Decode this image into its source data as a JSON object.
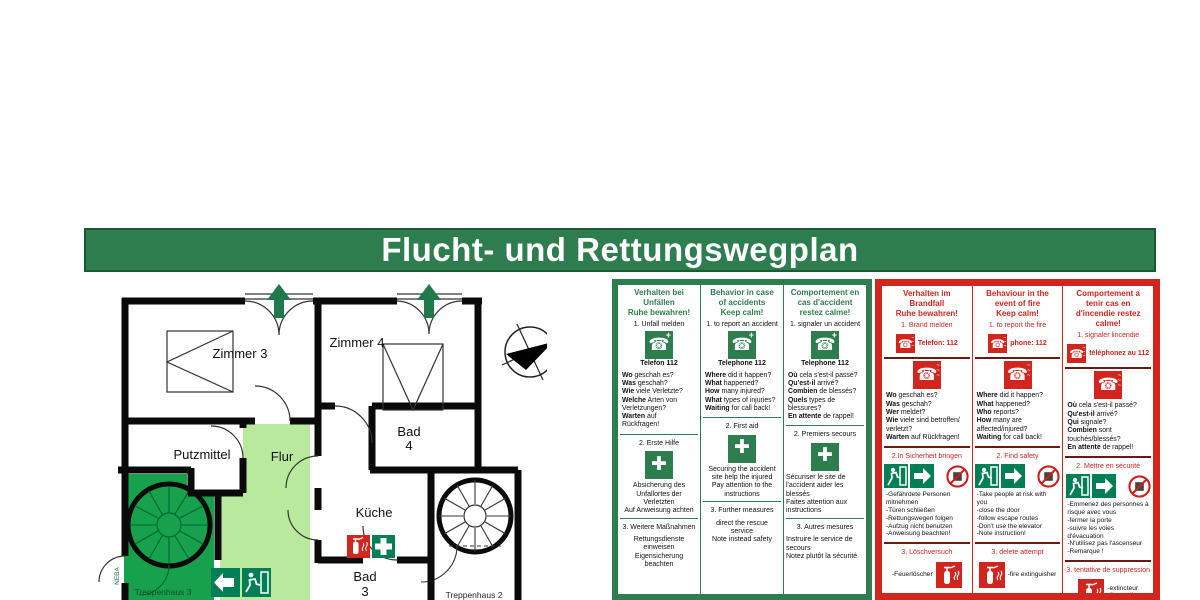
{
  "title": "Flucht- und Rettungswegplan",
  "colors": {
    "safety_green": "#2e7d4e",
    "safety_red": "#d1251d",
    "corridor_light_green": "#b9e99d",
    "stair_green": "#18a14d",
    "sign_green": "#007f56"
  },
  "floorplan": {
    "rooms": {
      "zimmer3": "Zimmer 3",
      "zimmer4": "Zimmer 4",
      "bad4_l1": "Bad",
      "bad4_l2": "4",
      "putzmittel": "Putzmittel",
      "flur": "Flur",
      "kueche": "Küche",
      "bad3_l1": "Bad",
      "bad3_l2": "3",
      "treppenhaus3": "Treppenhaus 3",
      "treppenhaus2": "Treppenhaus 2"
    },
    "compass_label": "Z",
    "side_label": "NEBA"
  },
  "accident_panel": {
    "columns": [
      {
        "header": "Verhalten bei\nUnfällen\nRuhe bewahren!",
        "step1": "1. Unfall melden",
        "phone_label": "Telefon  112",
        "questions": [
          {
            "b": "Wo",
            "t": " geschah es?"
          },
          {
            "b": "Was",
            "t": " geschah?"
          },
          {
            "b": "Wie",
            "t": " viele Verletzte?"
          },
          {
            "b": "Welche",
            "t": " Arten von"
          },
          {
            "b": "",
            "t": "Verletzungen?"
          },
          {
            "b": "Warten",
            "t": " auf"
          },
          {
            "b": "",
            "t": "Rückfragen!"
          }
        ],
        "step2": "2. Erste Hilfe",
        "step2_text": "Absicherung des\nUnfallortes der\nVerletzten\nAuf Anweisung achten",
        "step3": "3. Weitere Maßnahmen",
        "step3_text": "Rettungsdienste\neinweisen\nEigensicherung\nbeachten"
      },
      {
        "header": "Behavior in case\nof accidents\nKeep calm!",
        "step1": "1. to report an accident",
        "phone_label": "Telephone  112",
        "questions": [
          {
            "b": "Where",
            "t": " did it happen?"
          },
          {
            "b": "What",
            "t": " happened?"
          },
          {
            "b": "How",
            "t": " many injured?"
          },
          {
            "b": "What",
            "t": " types of injuries?"
          },
          {
            "b": "Waiting",
            "t": " for call back!"
          }
        ],
        "step2": "2. First aid",
        "step2_text": "Securing the accident\nsite help the injured\nPay attention to the\ninstructions",
        "step3": "3. Further measures",
        "step3_text": "direct the rescue\nservice\nNote instead safety"
      },
      {
        "header": "Comportement en\ncas d'accident\nrestez calme!",
        "step1": "1. signaler un accident",
        "phone_label": "Telephone  112",
        "questions": [
          {
            "b": "Où",
            "t": " cela s'est-il passé?"
          },
          {
            "b": "Qu'est-il",
            "t": " arrivé?"
          },
          {
            "b": "Combien",
            "t": " de blessés?"
          },
          {
            "b": "Quels",
            "t": " types de"
          },
          {
            "b": "",
            "t": "blessures?"
          },
          {
            "b": "En attente",
            "t": " de rappel!"
          }
        ],
        "step2": "2. Premiers secours",
        "step2_text": "Sécuriser le site de\nl'accident aider les\nblessés\nFaites attention aux\ninstructions",
        "step3": "3. Autres mesures",
        "step3_text": "Instruire le service de\nsecours\nNotez plutôt la sécurité"
      }
    ]
  },
  "fire_panel": {
    "columns": [
      {
        "header": "Verhalten im\nBrandfall\nRuhe bewahren!",
        "step1": "1. Brand melden",
        "phone_label": "Telefon: 112",
        "questions": [
          {
            "b": "Wo",
            "t": " geschah es?"
          },
          {
            "b": "Was",
            "t": " geschah?"
          },
          {
            "b": "Wer",
            "t": " meldet?"
          },
          {
            "b": "Wie",
            "t": " viele sind betroffen/"
          },
          {
            "b": "",
            "t": "verletzt?"
          },
          {
            "b": "Warten",
            "t": " auf Rückfragen!"
          }
        ],
        "step2": "2.In Sicherheit bringen",
        "bullets": [
          "-Gefährdete Personen",
          "mitnehmen",
          "-Türen schließen",
          "-Rettungswegen folgen",
          "-Aufzug nicht benutzen",
          "-Anweisung beachten!"
        ],
        "step3": "3. Löschversuch",
        "ext_label": "-Feuerlöscher"
      },
      {
        "header": "Behaviour in the\nevent of fire\nKeep calm!",
        "step1": "1. to report the fire",
        "phone_label": "phone: 112",
        "questions": [
          {
            "b": "Where",
            "t": " did it happen?"
          },
          {
            "b": "What",
            "t": " happened?"
          },
          {
            "b": "Who",
            "t": " reports?"
          },
          {
            "b": "How",
            "t": " many are"
          },
          {
            "b": "",
            "t": "affected/injured?"
          },
          {
            "b": "Waiting",
            "t": " for call back!"
          }
        ],
        "step2": "2. Find safety",
        "bullets": [
          "-Take people at risk with",
          "you",
          "-close the door",
          "-follow escape routes",
          "-Don't use the elevator",
          "-Note instruction!"
        ],
        "step3": "3. delete attempt",
        "ext_label": "-fire extinguisher"
      },
      {
        "header": "Comportement a\ntenir cas en\nd'incendie restez\ncalme!",
        "step1": "1. signaler lincendie",
        "phone_label": "téléphonez au 112",
        "questions": [
          {
            "b": "Où",
            "t": " cela s'est-il passé?"
          },
          {
            "b": "Qu'est-il",
            "t": " arrivé?"
          },
          {
            "b": "Qui",
            "t": " signale?"
          },
          {
            "b": "Combien",
            "t": " sont"
          },
          {
            "b": "",
            "t": "touchés/blessés?"
          },
          {
            "b": "En attente",
            "t": " de rappel!"
          }
        ],
        "step2": "2. Mettre en sécurité",
        "bullets": [
          "-Emmenez des personnes à",
          "risque avec vous",
          "-fermer la porte",
          "-suivre les voies d'évacuation",
          "-N'utilisez pas l'ascenseur",
          "-Remarque !"
        ],
        "step3": "3. tentative de suppression",
        "ext_label": "-extincteur\nd'incendie"
      }
    ]
  }
}
